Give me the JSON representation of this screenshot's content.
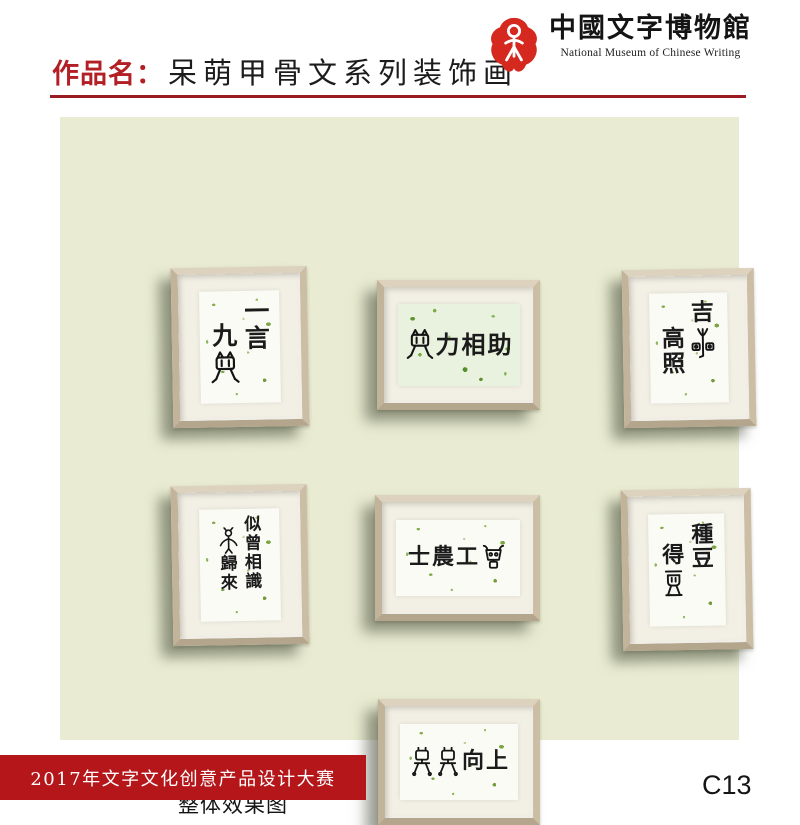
{
  "header": {
    "work_label": "作品名：",
    "work_title": "呆萌甲骨文系列装饰画",
    "museum_name_cn": "中國文字博物館",
    "museum_name_en": "National Museum of Chinese Writing"
  },
  "panel_caption": "整体效果图",
  "frames": [
    {
      "id": "f1",
      "phrase": "一言九鼎",
      "layout": "vertical",
      "columns": [
        [
          "一",
          "言"
        ],
        [
          "九",
          {
            "g": "ding"
          }
        ]
      ]
    },
    {
      "id": "f2",
      "phrase": "鼎力相助",
      "layout": "horizontal",
      "columns": [
        [
          {
            "g": "ding"
          },
          "力",
          "相",
          "助"
        ]
      ]
    },
    {
      "id": "f3",
      "phrase": "吉星高照",
      "layout": "vertical",
      "columns": [
        [
          "吉",
          {
            "g": "xing"
          }
        ],
        [
          "高",
          "照"
        ]
      ]
    },
    {
      "id": "f4",
      "phrase": "似曾相識燕歸來",
      "layout": "vertical",
      "columns": [
        [
          "似",
          "曾",
          "相",
          "識"
        ],
        [
          {
            "g": "yan"
          },
          "歸",
          "來"
        ]
      ]
    },
    {
      "id": "f5",
      "phrase": "士農工商",
      "layout": "horizontal",
      "columns": [
        [
          "士",
          "農",
          "工",
          {
            "g": "shang"
          }
        ]
      ]
    },
    {
      "id": "f6",
      "phrase": "種豆得豆",
      "layout": "vertical",
      "columns": [
        [
          "種",
          "豆"
        ],
        [
          "得",
          {
            "g": "dou"
          }
        ]
      ]
    },
    {
      "id": "f7",
      "phrase": "天天向上",
      "layout": "horizontal",
      "columns": [
        [
          {
            "g": "tian"
          },
          {
            "g": "tian"
          },
          "向",
          "上"
        ]
      ]
    }
  ],
  "glyphs": {
    "ding": "oracle-ding-cauldron-cat-glyph",
    "xing": "oracle-xing-star-glyph",
    "yan": "oracle-yan-swallow-glyph",
    "shang": "oracle-shang-glyph",
    "dou": "oracle-dou-vessel-glyph",
    "tian": "oracle-tian-figure-glyph"
  },
  "footer": {
    "competition": "2017年文字文化创意产品设计大赛",
    "entry_code": "C13"
  },
  "colors": {
    "title_red": "#b21f24",
    "rule_red": "#9a1b20",
    "banner_red": "#b5161a",
    "logo_red": "#d5281e",
    "wall_green": "#e9ecd2",
    "frame_wood": "#cbbea5",
    "mat_cream": "#f2efe4"
  }
}
